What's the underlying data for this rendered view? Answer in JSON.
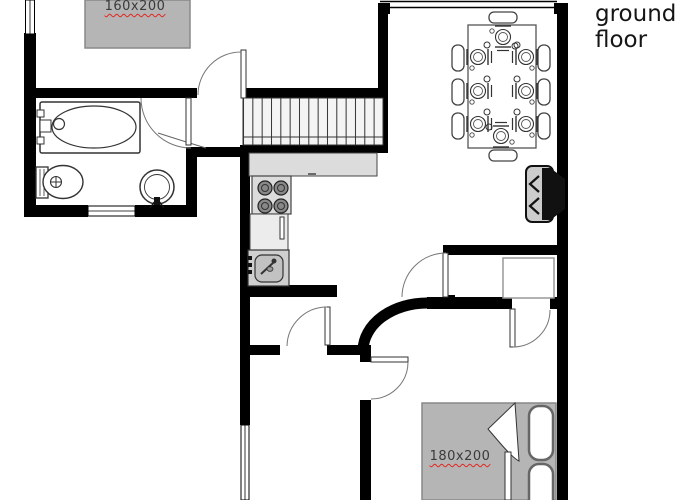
{
  "title": {
    "line1": "ground",
    "line2": "floor"
  },
  "labels": {
    "bed1": "160x200",
    "bed2": "180x200"
  },
  "colors": {
    "wall": "#000000",
    "bed_fill": "#b5b5b5",
    "counter_fill": "#dcdcdc",
    "cabinet_fill": "#ececec",
    "sink_unit_fill": "#cfcfcf",
    "stove_body_fill": "#cccccc",
    "burner_fill": "#888888",
    "misspell_underline": "#e2251f",
    "label_text": "#3a3a3a",
    "title_text": "#151515"
  }
}
